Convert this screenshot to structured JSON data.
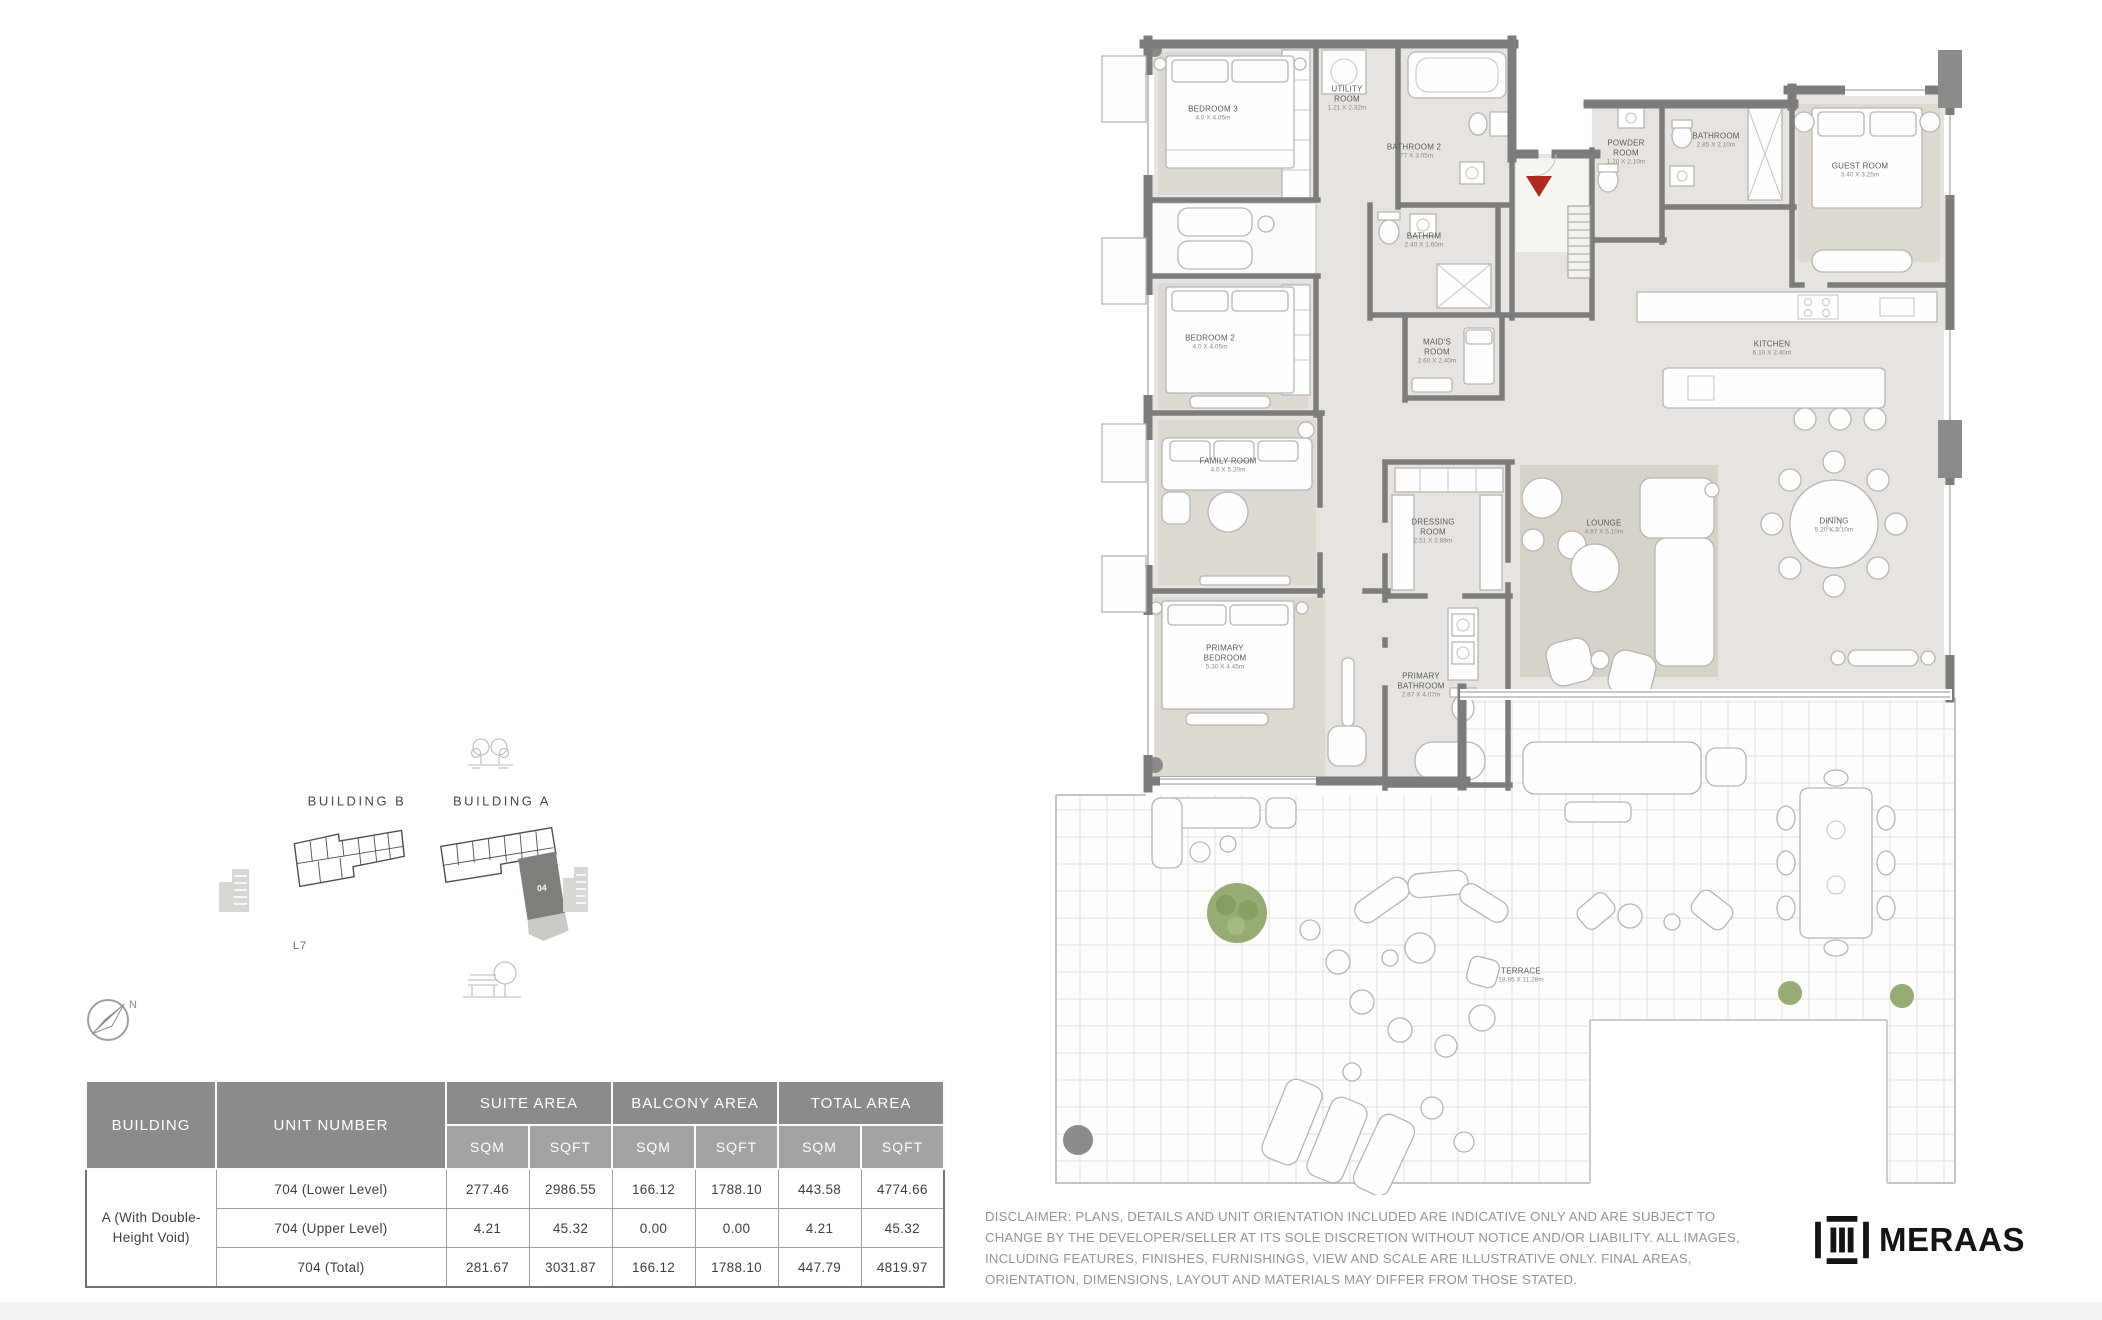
{
  "key_plan": {
    "building_b_label": "BUILDING B",
    "building_a_label": "BUILDING A",
    "level_label": "L7",
    "unit_badge": "04",
    "compass_label": "N"
  },
  "floor_plan": {
    "rooms": [
      {
        "name": "BEDROOM 3",
        "dims": "4.0 X 4.05m",
        "x": 1213,
        "y": 114
      },
      {
        "name": "UTILITY ROOM",
        "dims": "1.21 X 2.32m",
        "x": 1347,
        "y": 99,
        "w": 52
      },
      {
        "name": "BATHROOM 2",
        "dims": "2.77 X 3.05m",
        "x": 1414,
        "y": 152
      },
      {
        "name": "BATHRM",
        "dims": "2.40 X 1.60m",
        "x": 1424,
        "y": 241
      },
      {
        "name": "MAID'S ROOM",
        "dims": "2.60 X 2.40m",
        "x": 1437,
        "y": 352,
        "w": 42
      },
      {
        "name": "BEDROOM 2",
        "dims": "4.0 X 4.05m",
        "x": 1210,
        "y": 343
      },
      {
        "name": "FAMILY ROOM",
        "dims": "4.0 X 5.20m",
        "x": 1228,
        "y": 466
      },
      {
        "name": "DRESSING ROOM",
        "dims": "2.51 X 2.88m",
        "x": 1433,
        "y": 532,
        "w": 54
      },
      {
        "name": "PRIMARY BEDROOM",
        "dims": "5.30 X 4.45m",
        "x": 1225,
        "y": 658,
        "w": 62
      },
      {
        "name": "PRIMARY BATHROOM",
        "dims": "2.87 X 4.07m",
        "x": 1421,
        "y": 686,
        "w": 66
      },
      {
        "name": "POWDER ROOM",
        "dims": "1.20 X 2.10m",
        "x": 1626,
        "y": 153,
        "w": 50
      },
      {
        "name": "BATHROOM",
        "dims": "2.85 X 2.10m",
        "x": 1716,
        "y": 141
      },
      {
        "name": "GUEST ROOM",
        "dims": "3.40 X 3.25m",
        "x": 1860,
        "y": 171
      },
      {
        "name": "KITCHEN",
        "dims": "6.10 X 2.40m",
        "x": 1772,
        "y": 349
      },
      {
        "name": "LOUNGE",
        "dims": "4.87 X 5.10m",
        "x": 1604,
        "y": 528
      },
      {
        "name": "DINING",
        "dims": "5.20 X 5.10m",
        "x": 1834,
        "y": 526
      },
      {
        "name": "TERRACE",
        "dims": "18.95 X 11.28m",
        "x": 1521,
        "y": 976
      }
    ]
  },
  "table": {
    "building_header": "BUILDING",
    "unit_header": "UNIT NUMBER",
    "groups": [
      "SUITE AREA",
      "BALCONY AREA",
      "TOTAL AREA"
    ],
    "sub_headers": [
      "SQM",
      "SQFT",
      "SQM",
      "SQFT",
      "SQM",
      "SQFT"
    ],
    "building_label": "A (With Double-Height Void)",
    "rows": [
      {
        "unit": "704 (Lower Level)",
        "values": [
          "277.46",
          "2986.55",
          "166.12",
          "1788.10",
          "443.58",
          "4774.66"
        ]
      },
      {
        "unit": "704 (Upper Level)",
        "values": [
          "4.21",
          "45.32",
          "0.00",
          "0.00",
          "4.21",
          "45.32"
        ]
      },
      {
        "unit": "704 (Total)",
        "values": [
          "281.67",
          "3031.87",
          "166.12",
          "1788.10",
          "447.79",
          "4819.97"
        ]
      }
    ]
  },
  "disclaimer": "DISCLAIMER: PLANS, DETAILS AND UNIT ORIENTATION INCLUDED ARE INDICATIVE ONLY AND ARE SUBJECT TO CHANGE BY THE DEVELOPER/SELLER AT ITS SOLE DISCRETION WITHOUT NOTICE AND/OR LIABILITY. ALL IMAGES, INCLUDING FEATURES, FINISHES, FURNISHINGS, VIEW AND SCALE ARE ILLUSTRATIVE ONLY. FINAL AREAS, ORIENTATION, DIMENSIONS, LAYOUT AND MATERIALS MAY DIFFER FROM THOSE STATED.",
  "brand": {
    "logo_text": "MERAAS"
  },
  "colors": {
    "table_header_bg": "#8c8b89",
    "table_subheader_bg": "#a5a3a1",
    "entry_marker": "#b02a23",
    "wall": "#7d7c7a",
    "tree_green": "#97ab74"
  }
}
